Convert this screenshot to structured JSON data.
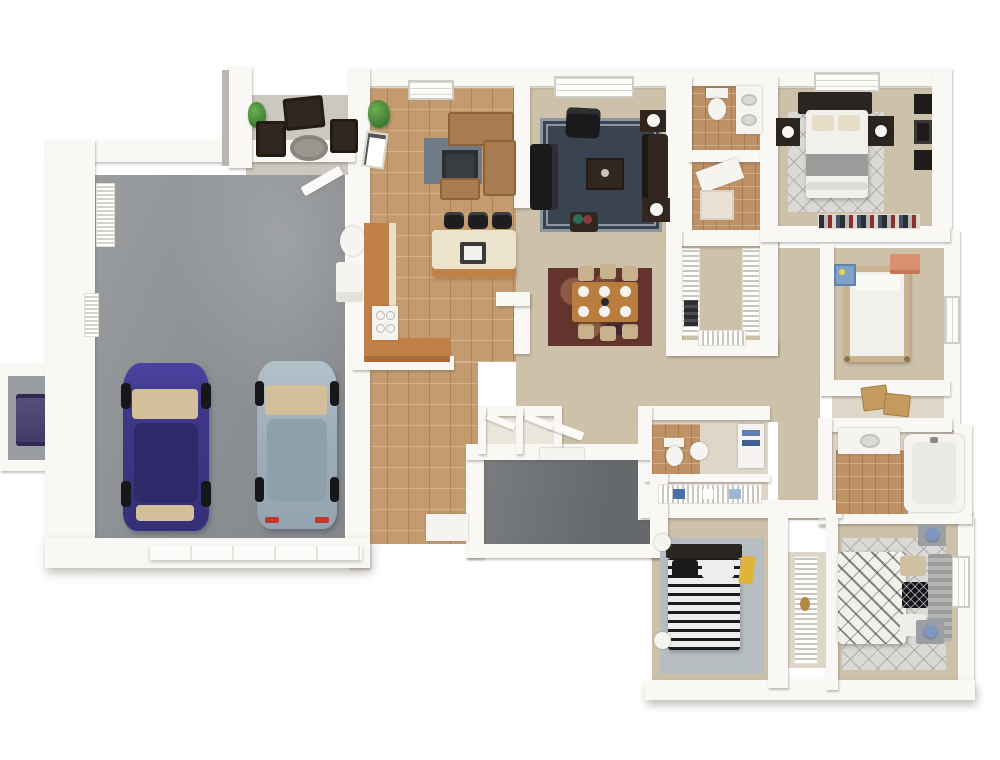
{
  "scene": {
    "title": "3D dollhouse-view floor plan of a single-story home with attached two-car garage",
    "view": "top-down 3D render",
    "background": "#ffffff",
    "visible_text": []
  },
  "colors": {
    "wall": "#f9f8f5",
    "wall-shadow": "#e4e1da",
    "garage-floor": "#8f9294",
    "porch-floor": "#6f7274",
    "patio-floor": "#ccc7bf",
    "carpet": "#cdc1aa",
    "carpet-pale": "#ded7c8",
    "tile-kitchen": "#c49b6e",
    "tile-bath": "#bf9265",
    "counter-wood": "#c08146",
    "island-cream": "#ece3cc",
    "stool-black": "#1d1d20",
    "sofa-tan": "#a87c50",
    "sofa-tan-dark": "#8d6238",
    "rug-family": "#6f7b87",
    "rug-living": "#3a4450",
    "rug-living-border": "#8d97a2",
    "rug-dining": "#63332e",
    "rug-dining-spot": "#8a5a42",
    "wood-table": "#b97e3f",
    "chair-tan": "#c8b28b",
    "black-furniture": "#1a1a1c",
    "dark-brown": "#32271f",
    "car-purple": "#443c8f",
    "car-purple-dark": "#2e2a6a",
    "car-silver": "#a6b6c0",
    "car-silver-dark": "#8fa0ad",
    "glass-tan": "#d3c09a",
    "white-fixture": "#f5f4f1",
    "bed-white": "#f1f0ed",
    "blanket-gray": "#9b9b99",
    "headboard-dark": "#2a2521",
    "rug-light": "#dbd9d5",
    "rug-blue-gray": "#b7bec2",
    "wood-light": "#cbb391",
    "dresser-salmon": "#d98f70",
    "accent-blue": "#7f96c0",
    "accent-yellow": "#e0b33a",
    "cardboard": "#c59a5e",
    "plant-green": "#4c8a40",
    "shelf-stripe": "#c9c6c0",
    "taillight-red": "#c0392b",
    "stand-gray": "#9aa0a6"
  },
  "rooms": [
    {
      "name": "garage",
      "floor": "gray concrete",
      "contents": [
        "purple-sedan",
        "silver-sedan",
        "water-heater",
        "washer",
        "wall-vent-x2",
        "garage-door"
      ]
    },
    {
      "name": "patio",
      "floor": "light gray",
      "contents": [
        "patio-bench",
        "patio-chair-x2",
        "round-patio-rug",
        "potted-plant"
      ]
    },
    {
      "name": "family-room",
      "floor": "tan tile",
      "contents": [
        "tan-sectional-sofa",
        "blue-gray-rug",
        "media-table",
        "potted-plant",
        "leaning-art",
        "window"
      ]
    },
    {
      "name": "kitchen",
      "floor": "tan tile",
      "contents": [
        "l-shaped-counter",
        "range",
        "island-with-sink",
        "bar-stool-x3"
      ]
    },
    {
      "name": "living-room",
      "floor": "tan carpet",
      "contents": [
        "black-sofa",
        "armchair",
        "loveseat",
        "coffee-table",
        "end-table-x2",
        "lamp-x2",
        "flower-stand",
        "navy-bordered-rug",
        "double-window"
      ]
    },
    {
      "name": "dining-area",
      "floor": "tan carpet",
      "contents": [
        "dining-table",
        "dining-chair-x6",
        "place-setting-x6",
        "burgundy-rug"
      ]
    },
    {
      "name": "entry-foyer",
      "floor": "tan tile",
      "contents": [
        "console-table",
        "coat-closet-x2"
      ]
    },
    {
      "name": "entry-porch",
      "floor": "dark gray",
      "contents": [
        "front-door"
      ]
    },
    {
      "name": "master-bathroom",
      "floor": "terracotta tile",
      "contents": [
        "toilet",
        "vanity",
        "shower"
      ]
    },
    {
      "name": "walk-in-closet",
      "floor": "tan carpet",
      "contents": [
        "wire-shelving",
        "hanging-clothes",
        "bench"
      ]
    },
    {
      "name": "master-bedroom",
      "floor": "tan carpet",
      "contents": [
        "double-bed",
        "dark-headboard",
        "nightstand-x2",
        "white-lamp-x2",
        "lattice-rug",
        "wall-art-frames",
        "closet-clothes-rail",
        "window"
      ]
    },
    {
      "name": "bedroom-2",
      "floor": "tan carpet",
      "contents": [
        "poster-bed",
        "salmon-dresser",
        "toy-shelf",
        "window"
      ]
    },
    {
      "name": "bedroom-2-closet",
      "floor": "tan carpet",
      "contents": [
        "moving-box-x2"
      ]
    },
    {
      "name": "hall-bathroom",
      "floor": "pale tile",
      "contents": [
        "toilet",
        "pedestal-sink",
        "towel-cabinet"
      ]
    },
    {
      "name": "linen-closet",
      "floor": "pale carpet",
      "contents": [
        "wire-shelf",
        "linens"
      ]
    },
    {
      "name": "bathroom-2",
      "floor": "terracotta tile",
      "contents": [
        "vanity-with-sink",
        "bathtub"
      ]
    },
    {
      "name": "bedroom-3",
      "floor": "tan carpet",
      "contents": [
        "striped-bed",
        "round-side-table-x2",
        "blue-gray-rug",
        "yellow-throw"
      ]
    },
    {
      "name": "wardrobe-closet",
      "floor": "pale carpet",
      "contents": [
        "wire-shelving"
      ]
    },
    {
      "name": "bedroom-4",
      "floor": "tan carpet",
      "contents": [
        "bed-with-patterned-pillows",
        "striped-bench",
        "nightstand-x2",
        "blue-lamp-x2",
        "lattice-rug",
        "door"
      ]
    },
    {
      "name": "hallway",
      "floor": "tan carpet",
      "contents": []
    },
    {
      "name": "utility-alcove",
      "floor": "gray",
      "contents": [
        "ac-unit"
      ]
    }
  ],
  "vehicles": [
    {
      "name": "purple-sedan",
      "body_color": "#443c8f",
      "orientation": "nose-up"
    },
    {
      "name": "silver-sedan",
      "body_color": "#a6b6c0",
      "orientation": "nose-up"
    }
  ]
}
